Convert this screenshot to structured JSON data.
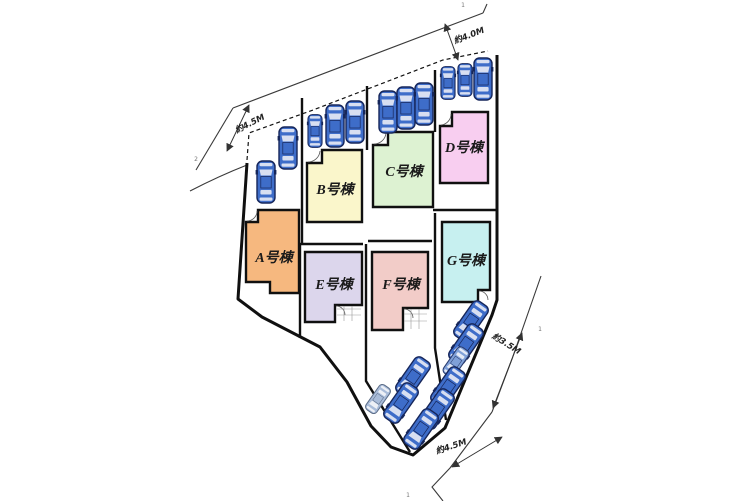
{
  "site_plan": {
    "background": "#FFFFFF",
    "boundary_color": "#101010",
    "road_line_color": "#3a3a3a",
    "buildings": [
      {
        "id": "a",
        "label": "A号棟",
        "color": "#F6B87F"
      },
      {
        "id": "b",
        "label": "B号棟",
        "color": "#FAF6CB"
      },
      {
        "id": "c",
        "label": "C号棟",
        "color": "#DDF2D2"
      },
      {
        "id": "d",
        "label": "D号棟",
        "color": "#F8CEF0"
      },
      {
        "id": "e",
        "label": "E号棟",
        "color": "#DCD6EC"
      },
      {
        "id": "f",
        "label": "F号棟",
        "color": "#F2CCC8"
      },
      {
        "id": "g",
        "label": "G号棟",
        "color": "#C7F0F0"
      }
    ],
    "dimensions": [
      {
        "id": "top",
        "label": "約4.0M"
      },
      {
        "id": "left",
        "label": "約4.5M"
      },
      {
        "id": "right",
        "label": "約3.5M"
      },
      {
        "id": "bottom",
        "label": "約4.5M"
      }
    ],
    "survey_marks": [
      {
        "id": "top-right",
        "label": "1"
      },
      {
        "id": "left",
        "label": "2"
      },
      {
        "id": "right",
        "label": "1"
      },
      {
        "id": "bottom",
        "label": "1"
      }
    ],
    "cars": {
      "top_row_count": 11,
      "bottom_row_count": 9,
      "blue": {
        "body": "#3E6DC9",
        "outline": "#16265A",
        "glass": "#D8DFF1"
      },
      "light": {
        "body": "#7FA0D8",
        "outline": "#2A3C6E",
        "glass": "#E4EAF6"
      },
      "gray": {
        "body": "#A9BCD9",
        "outline": "#5A6B86",
        "glass": "#EDF0F6"
      }
    }
  }
}
